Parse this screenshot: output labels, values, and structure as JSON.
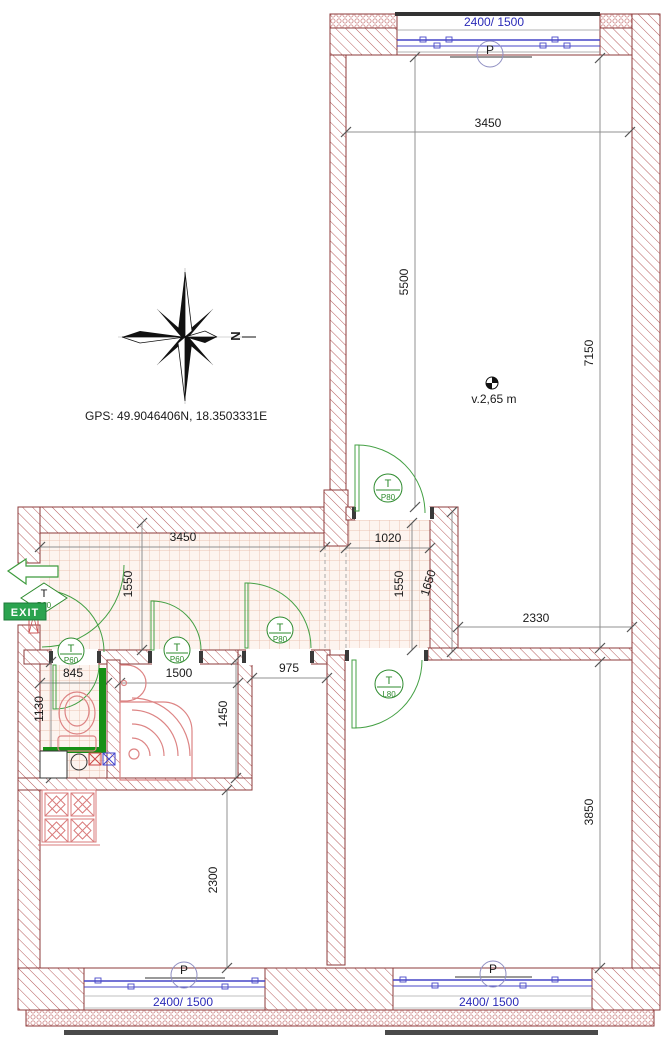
{
  "annotations": {
    "gps": "GPS: 49.9046406N, 18.3503331E",
    "ceiling_height": "v.2,65 m",
    "exit": "EXIT",
    "north_letter": "N"
  },
  "windows": {
    "top": {
      "size": "2400/ 1500",
      "mark": "P"
    },
    "bottom_left": {
      "size": "2400/ 1500",
      "mark": "P"
    },
    "bottom_right": {
      "size": "2400/ 1500",
      "mark": "P"
    }
  },
  "doors": {
    "entry": {
      "type": "T",
      "size": "P80"
    },
    "wc": {
      "type": "T",
      "size": "P60"
    },
    "bathroom": {
      "type": "T",
      "size": "P60"
    },
    "middle_room": {
      "type": "T",
      "size": "P80"
    },
    "top_room": {
      "type": "T",
      "size": "P80"
    },
    "bottom_right_room": {
      "type": "T",
      "size": "L80"
    }
  },
  "dimensions": {
    "top_room_width": "3450",
    "top_room_depth": "5500",
    "right_side_total": "7150",
    "lower_right_width": "2330",
    "vestibule_width": "1020",
    "vestibule_depth": "1550",
    "vestibule_wall": "1650",
    "corridor_width": "3450",
    "corridor_depth": "1550",
    "wc_width": "845",
    "wc_depth": "1130",
    "bathroom_width": "1500",
    "bathroom_depth": "1450",
    "niche_width": "975",
    "middle_room_depth": "2300",
    "bottom_right_depth": "3850"
  },
  "colors": {
    "wall_outline": "#8d3b3b",
    "wall_hatch": "#b65c5c",
    "door_green": "#44a044",
    "window_blue": "#2b2bb8",
    "fixture_red": "#dd8484",
    "exit_green": "#2ba34f",
    "tile_line": "#eac3b3"
  }
}
